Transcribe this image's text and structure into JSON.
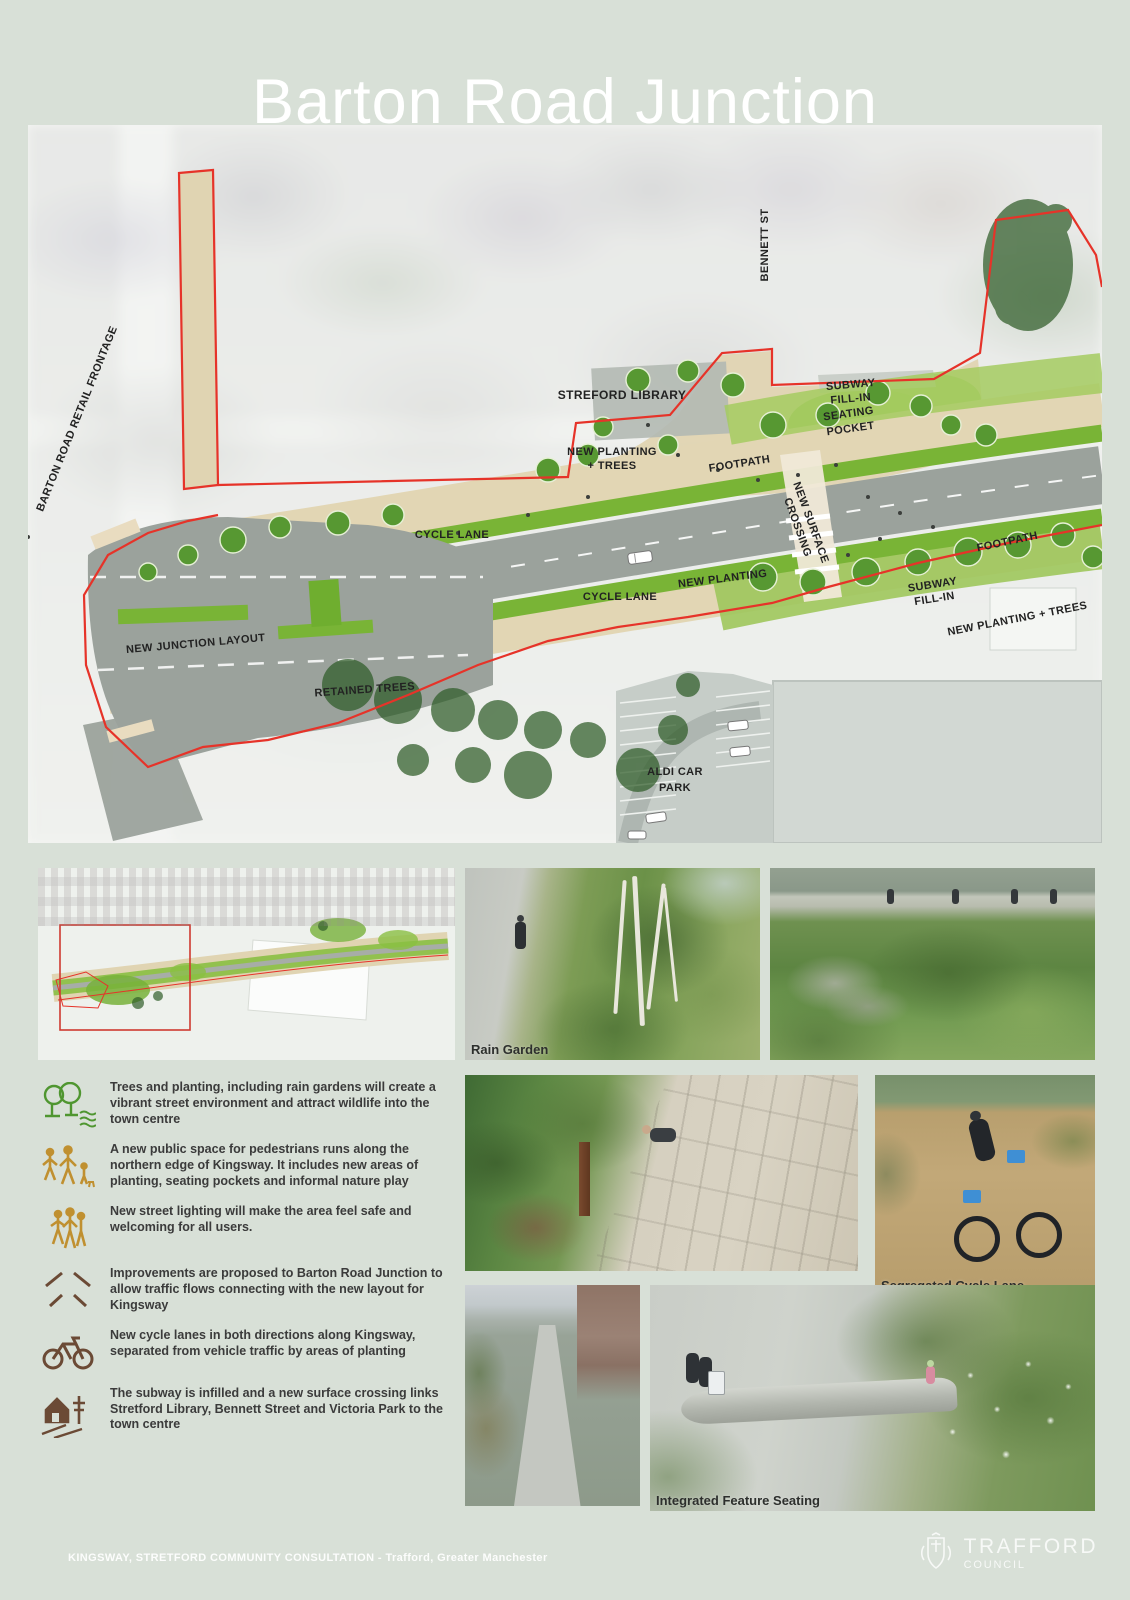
{
  "title": "Barton Road Junction",
  "colors": {
    "background": "#d8e0d7",
    "boundary_red": "#e63329",
    "plan_green": "#79b436",
    "plan_light_green": "#a5cb60",
    "footpath_tan": "#e2d6b4",
    "road_grey": "#9ba29c"
  },
  "map": {
    "labels": {
      "barton_frontage": "BARTON ROAD RETAIL FRONTAGE",
      "bennett_st": "BENNETT ST",
      "stretford_library": "STREFORD LIBRARY",
      "subway_top_1": "SUBWAY",
      "subway_top_2": "FILL-IN",
      "seating_1": "SEATING",
      "seating_2": "POCKET",
      "planting_left_1": "NEW PLANTING",
      "planting_left_2": "+ TREES",
      "footpath_mid": "FOOTPATH",
      "crossing_1": "NEW SURFACE",
      "crossing_2": "CROSSING",
      "footpath_right": "FOOTPATH",
      "subway_right_1": "SUBWAY",
      "subway_right_2": "FILL-IN",
      "planting_right": "NEW PLANTING + TREES",
      "new_planting": "NEW PLANTING",
      "cycle_top": "CYCLE LANE",
      "cycle_bottom": "CYCLE LANE",
      "junction_layout": "NEW JUNCTION LAYOUT",
      "retained_trees": "RETAINED TREES",
      "aldi_1": "ALDI CAR",
      "aldi_2": "PARK"
    }
  },
  "photos": {
    "rain_garden_caption": "Rain Garden",
    "cycle_lane_caption": "Segregated Cycle Lane",
    "seating_caption": "Integrated Feature Seating"
  },
  "bullets": [
    {
      "icon": "trees-icon",
      "text": "Trees and planting, including rain gardens will create a vibrant street environment and attract wildlife into the town centre"
    },
    {
      "icon": "pedestrians-icon",
      "text": "A new public space for pedestrians runs along the northern edge of Kingsway. It includes new areas of planting, seating pockets and informal nature play"
    },
    {
      "icon": "street-lighting-icon",
      "text": "New street lighting will make the area feel safe and welcoming for all users."
    },
    {
      "icon": "junction-icon",
      "text": "Improvements are proposed to Barton Road Junction to allow traffic flows connecting with the new layout for Kingsway"
    },
    {
      "icon": "cycle-icon",
      "text": "New cycle lanes in both directions along Kingsway, separated from vehicle traffic by areas of planting"
    },
    {
      "icon": "subway-crossing-icon",
      "text": "The subway is infilled and a new surface crossing links Stretford Library, Bennett Street and Victoria Park to the town centre"
    }
  ],
  "footer": {
    "project_line": "KINGSWAY, STRETFORD  COMMUNITY CONSULTATION - Trafford, Greater Manchester",
    "council_name": "TRAFFORD",
    "council_dept": "COUNCIL"
  }
}
